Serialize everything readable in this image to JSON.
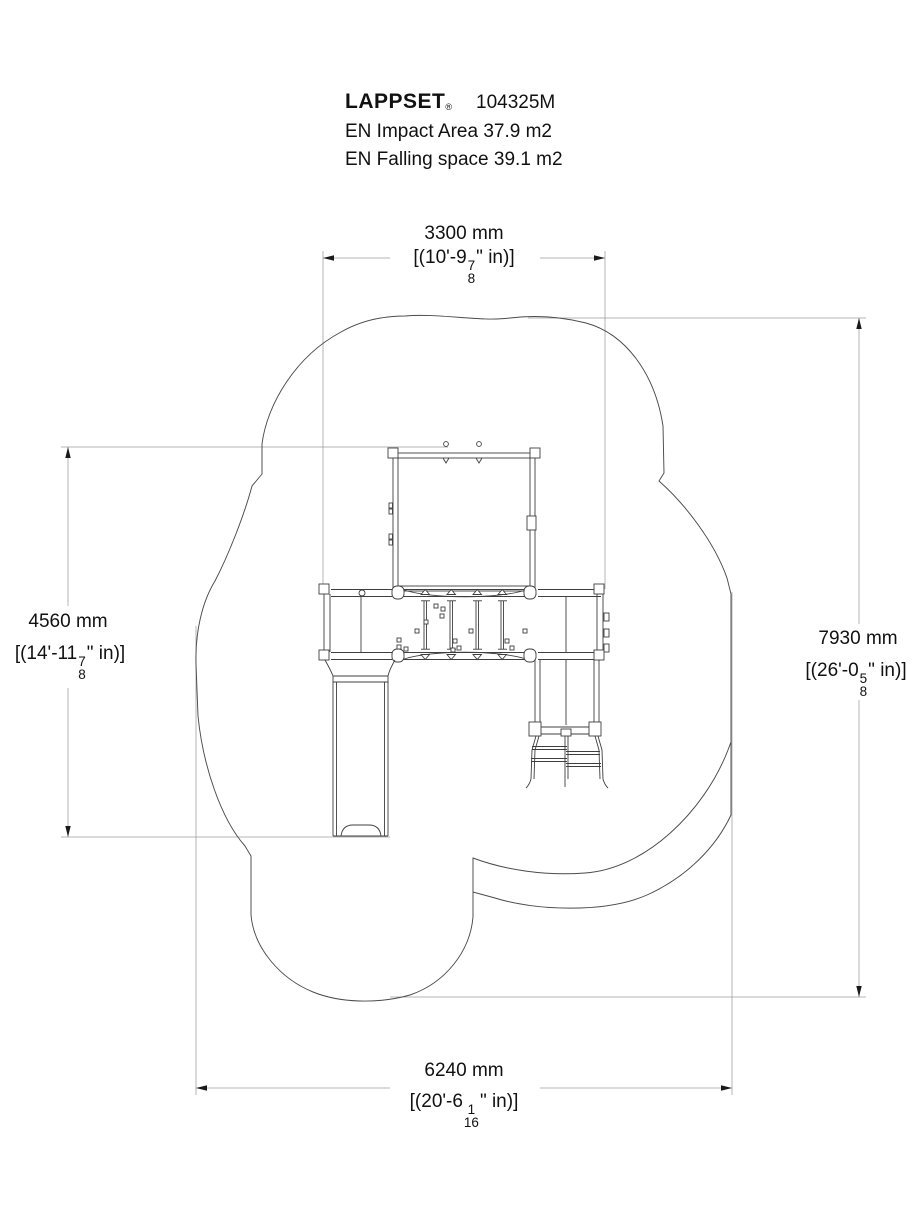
{
  "header": {
    "brand": "LAPPSET",
    "registered": "®",
    "model": "104325M",
    "impact_area_line": "EN Impact Area 37.9 m2",
    "falling_space_line": "EN Falling space 39.1 m2"
  },
  "dimensions": {
    "top": {
      "metric": "3300 mm",
      "imperial_prefix": "[(10'-9",
      "fraction_numerator": "7",
      "fraction_denominator": "8",
      "imperial_suffix": "\" in)]"
    },
    "left": {
      "metric": "4560 mm",
      "imperial_prefix": "[(14'-11",
      "fraction_numerator": "7",
      "fraction_denominator": "8",
      "imperial_suffix": "\" in)]"
    },
    "right": {
      "metric": "7930 mm",
      "imperial_prefix": "[(26'-0",
      "fraction_numerator": "5",
      "fraction_denominator": "8",
      "imperial_suffix": "\" in)]"
    },
    "bottom": {
      "metric": "6240 mm",
      "imperial_prefix": "[(20'-6",
      "fraction_numerator": "1",
      "fraction_denominator": "16",
      "imperial_suffix": "\" in)]"
    }
  },
  "drawing": {
    "colors": {
      "structure_line": "#3f3f3f",
      "safety_outline": "#4a4a4a",
      "dimension_line": "#9b9b9b",
      "text": "#111111",
      "background": "#ffffff"
    }
  }
}
